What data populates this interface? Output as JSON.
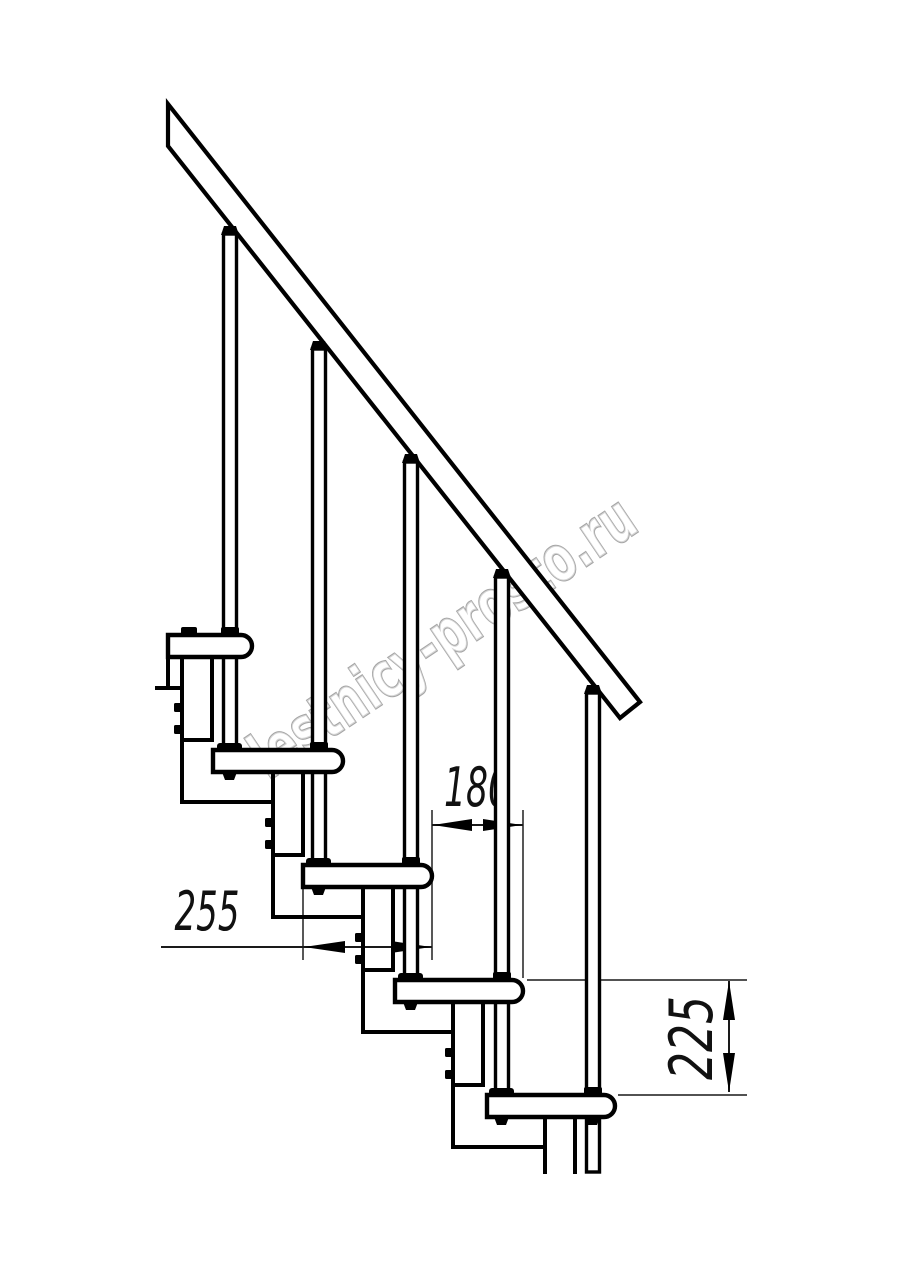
{
  "drawing": {
    "kind": "modular staircase side elevation, technical line drawing",
    "colors": {
      "background": "#ffffff",
      "line": "#000000",
      "dimension_line": "#1a1a1a",
      "watermark": "#a5a5a5"
    }
  },
  "watermark": {
    "text": "lestnicy-prosto.ru"
  },
  "dimensions": {
    "step_run": {
      "label": "180"
    },
    "tread_depth": {
      "label": "255"
    },
    "step_rise": {
      "label": "225"
    }
  }
}
